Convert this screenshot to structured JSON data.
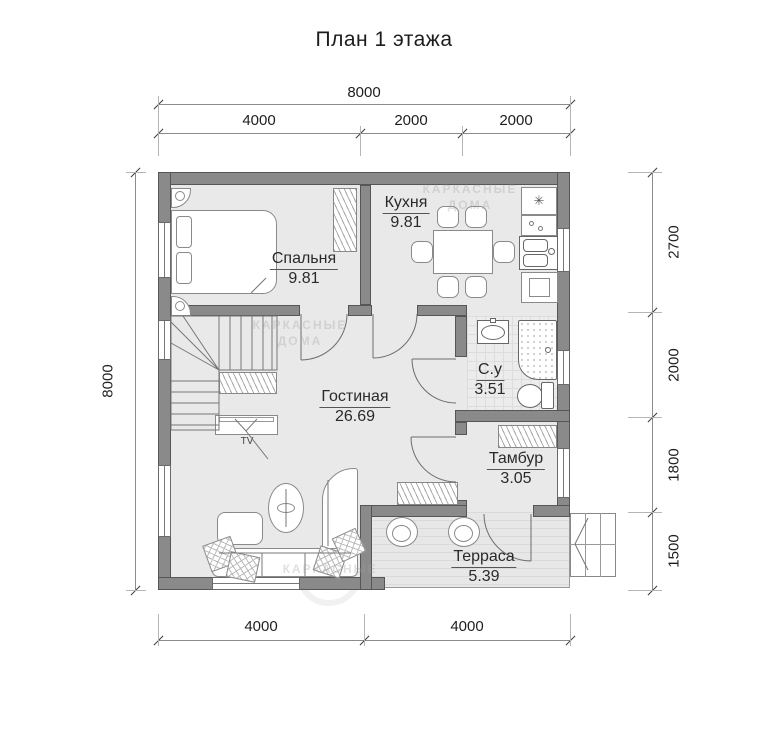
{
  "title": "План 1 этажа",
  "rooms": [
    {
      "id": "bedroom",
      "name": "Спальня",
      "area": "9.81"
    },
    {
      "id": "kitchen",
      "name": "Кухня",
      "area": "9.81"
    },
    {
      "id": "bathroom",
      "name": "С.у",
      "area": "3.51"
    },
    {
      "id": "tambour",
      "name": "Тамбур",
      "area": "3.05"
    },
    {
      "id": "living",
      "name": "Гостиная",
      "area": "26.69"
    },
    {
      "id": "terrace",
      "name": "Терраса",
      "area": "5.39"
    }
  ],
  "dimensions": {
    "top_total": "8000",
    "top_segments": [
      "4000",
      "2000",
      "2000"
    ],
    "left_total": "8000",
    "right_segments": [
      "2700",
      "2000",
      "1800",
      "1500"
    ],
    "bottom_segments": [
      "4000",
      "4000"
    ]
  },
  "labels": {
    "tv": "TV",
    "stove_symbol": "✳"
  },
  "watermark": {
    "line1": "КАРКАСНЫЕ",
    "line2": "ДОМА"
  },
  "colors": {
    "wall": "#8a8a8a",
    "wall_outline": "#565656",
    "floor": "#e9e9e9",
    "terrace_floor": "#e2e2e2",
    "furniture_line": "#8a8a8a",
    "text": "#1e1e1e"
  }
}
